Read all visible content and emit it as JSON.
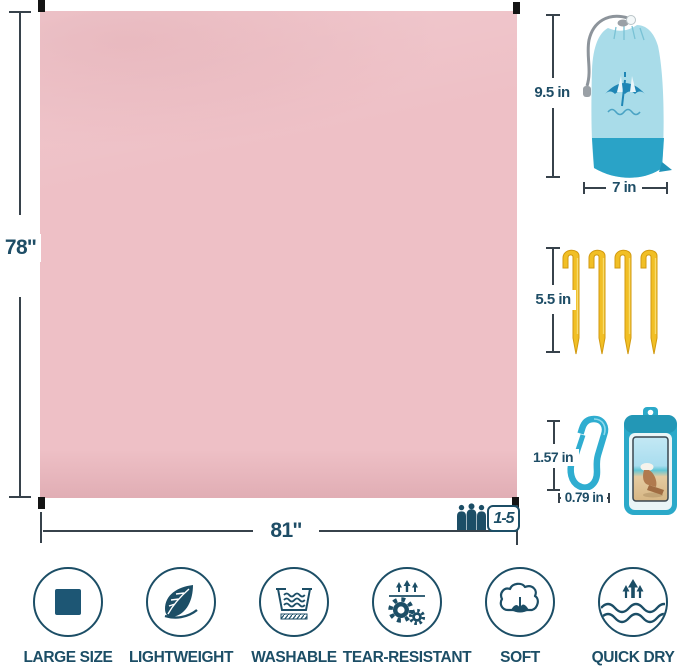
{
  "blanket": {
    "height_label": "78''",
    "width_label": "81''",
    "capacity_label": "1-5",
    "color": "#eec0c6"
  },
  "accessories": {
    "bag": {
      "height_label": "9.5 in",
      "width_label": "7 in"
    },
    "stakes": {
      "length_label": "5.5 in"
    },
    "carabiner": {
      "height_label": "1.57 in",
      "width_label": "0.79 in"
    }
  },
  "features": [
    {
      "label": "LARGE SIZE",
      "icon": "square-icon"
    },
    {
      "label": "LIGHTWEIGHT",
      "icon": "leaf-icon"
    },
    {
      "label": "WASHABLE",
      "icon": "wash-tub-icon"
    },
    {
      "label": "TEAR-RESISTANT",
      "icon": "gears-icon"
    },
    {
      "label": "SOFT",
      "icon": "cotton-icon"
    },
    {
      "label": "QUICK DRY",
      "icon": "waves-arrows-icon"
    }
  ],
  "colors": {
    "navy": "#1c4e66",
    "dimension_line": "#37424b",
    "blanket_pink": "#eec0c6",
    "bag_blue": "#a9dce9",
    "bag_band_teal": "#2aa3c7",
    "stake_yellow": "#f1bf25",
    "carabiner_teal": "#2fadd0",
    "pouch_teal": "#2ba9c9"
  }
}
